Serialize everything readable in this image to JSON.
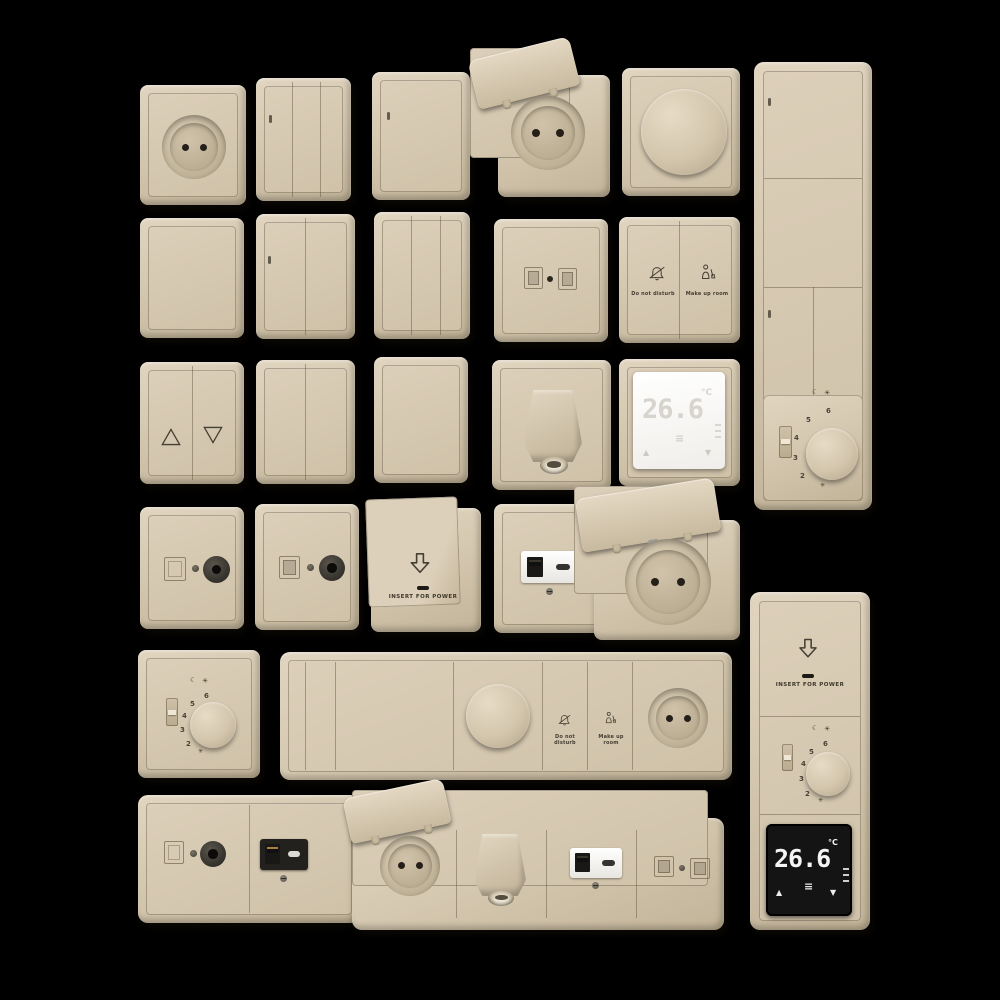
{
  "scene": {
    "background": "#000000",
    "plate_color": "#d6c9b1",
    "line_color": "#4a4236",
    "white_screen": "#f7f6f3",
    "black_screen": "#141414"
  },
  "labels": {
    "do_not_disturb": "Do not disturb",
    "make_up_room": "Make up room",
    "insert_for_power": "INSERT FOR POWER"
  },
  "dial": {
    "numbers": [
      "2",
      "3",
      "4",
      "5",
      "6"
    ],
    "night_symbol": "☾",
    "day_symbol": "☀",
    "frost_symbol": "✳"
  },
  "thermostat_white": {
    "temp": "26.6",
    "unit": "°C",
    "up": "▲",
    "down": "▼",
    "menu": "≡"
  },
  "thermostat_black": {
    "temp": "26.6",
    "unit": "°C",
    "up": "▲",
    "down": "▼",
    "menu": "≡"
  },
  "icons": {
    "do-not-disturb-icon": "crossed-bell",
    "make-up-room-icon": "housekeeper-with-broom",
    "insert-card-icon": "outline-down-arrow",
    "blinds-up-icon": "outline-up-triangle",
    "blinds-down-icon": "outline-down-triangle"
  },
  "fixtures": [
    "round socket",
    "triple rocker switch",
    "single rocker switch with indicator",
    "lidded socket open",
    "rotary dimmer",
    "vertical multi-switch panel with analog thermostat",
    "blank single rocker",
    "double rocker switch with indicator",
    "triple rocker switch",
    "dual data socket",
    "do-not-disturb / make-up-room switch",
    "blinds switch",
    "double rocker switch",
    "blank single rocker",
    "cable outlet spout",
    "digital thermostat white",
    "coax TV socket female",
    "coax TV socket male",
    "key card power holder",
    "USB A+C charger socket",
    "lidded schuko socket open",
    "analog dial thermostat",
    "horizontal panel: switches, dimmer, service buttons, socket",
    "coax + USB combo panel",
    "horizontal panel: lidded socket, cable outlet, USB, data",
    "vertical panel: card holder, dial thermostat, digital display"
  ]
}
